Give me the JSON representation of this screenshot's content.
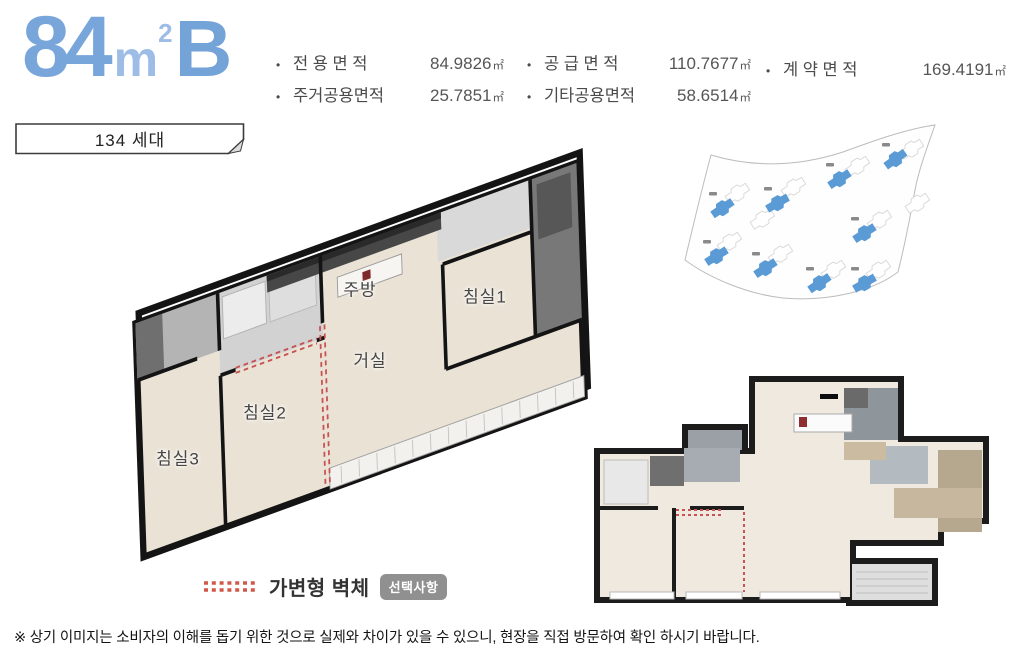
{
  "header": {
    "type_number": "84",
    "type_unit": "m",
    "type_sup": "2",
    "type_suffix": "B",
    "units_badge": "134 세대"
  },
  "specs": {
    "unit": "㎡",
    "columns": [
      {
        "items": [
          {
            "label": "전 용 면 적",
            "value": "84.9826"
          },
          {
            "label": "주거공용면적",
            "value": "25.7851"
          }
        ]
      },
      {
        "items": [
          {
            "label": "공 급 면 적",
            "value": "110.7677"
          },
          {
            "label": "기타공용면적",
            "value": "58.6514"
          }
        ]
      },
      {
        "items": [
          {
            "label": "계 약 면 적",
            "value": "169.4191"
          }
        ]
      }
    ]
  },
  "floorplan3d": {
    "rooms": [
      {
        "name": "주방"
      },
      {
        "name": "침실1"
      },
      {
        "name": "거실"
      },
      {
        "name": "침실2"
      },
      {
        "name": "침실3"
      }
    ]
  },
  "siteplan": {
    "highlight_color": "#5b9bd5",
    "highlighted_buildings": 9
  },
  "legend": {
    "label": "가변형 벽체",
    "badge": "선택사항",
    "dash_color": "#d05848"
  },
  "footer": {
    "note": "※ 상기 이미지는 소비자의 이해를 돕기 위한 것으로 실제와 차이가 있을 수 있으니, 현장을 직접 방문하여 확인 하시기 바랍니다."
  },
  "colors": {
    "accent_blue": "#79a6da",
    "accent_blue_light": "#9dbde6",
    "badge_gray": "#909090",
    "wall_black": "#1c1c1c",
    "floor_beige": "#efe9e0"
  }
}
